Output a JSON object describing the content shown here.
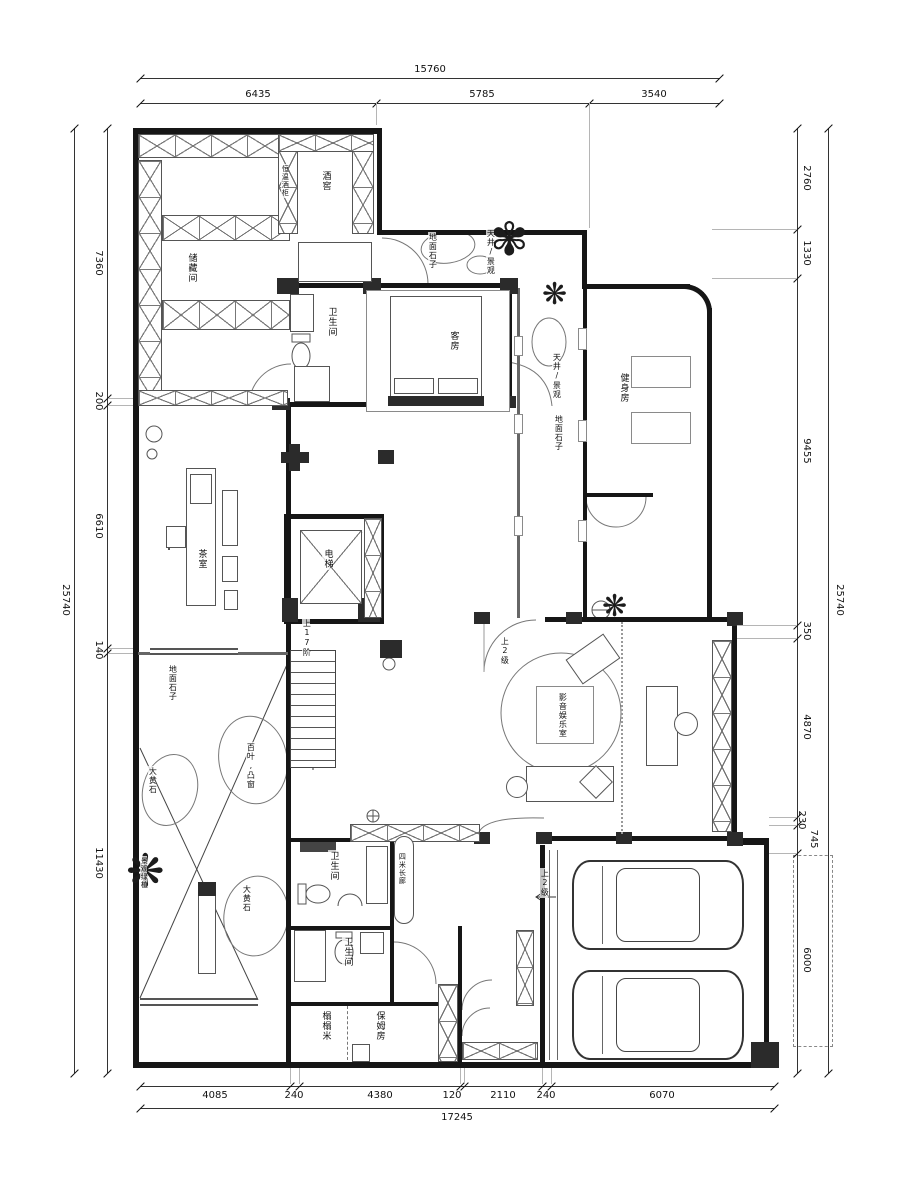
{
  "dimensions": {
    "top": {
      "total": "15760",
      "segments": [
        "6435",
        "5785",
        "3540"
      ]
    },
    "bottom": {
      "total": "17245",
      "segments": [
        "4085",
        "240",
        "4380",
        "120",
        "2110",
        "240",
        "6070"
      ]
    },
    "left": {
      "total": "25740",
      "segments": [
        "7360",
        "200",
        "6610",
        "140",
        "11430"
      ]
    },
    "right": {
      "total": "25740",
      "segments": [
        "2760",
        "1330",
        "9455",
        "350",
        "4870",
        "230",
        "745",
        "6000"
      ]
    }
  },
  "rooms": {
    "storage": "储藏间",
    "wine_cabinet": "恒温酒柜",
    "wine_cellar": "酒窖",
    "bath_top": "卫生间",
    "guest_room": "客房",
    "lightwell_top": "天井/景观",
    "pebbles_top": "地面石子",
    "lightwell_side": "天井/景观",
    "pebbles_side": "地面石子",
    "gym": "健身房",
    "tea_room": "茶室",
    "elevator": "电梯",
    "stairs_up": "上17阶",
    "pebbles_left": "地面石子",
    "boulder_1": "大黄石",
    "bay_window": "百叶,凸窗",
    "green_plants": "景观绿植",
    "boulder_2": "大黄石",
    "steps_theater": "上2级",
    "theater": "影音娱乐室",
    "bath_mid": "卫生间",
    "long_corridor": "四米长廊",
    "bath_low": "卫生间",
    "steps_garage": "上2级",
    "tatami": "榻榻米",
    "nanny_room": "保姆房"
  }
}
